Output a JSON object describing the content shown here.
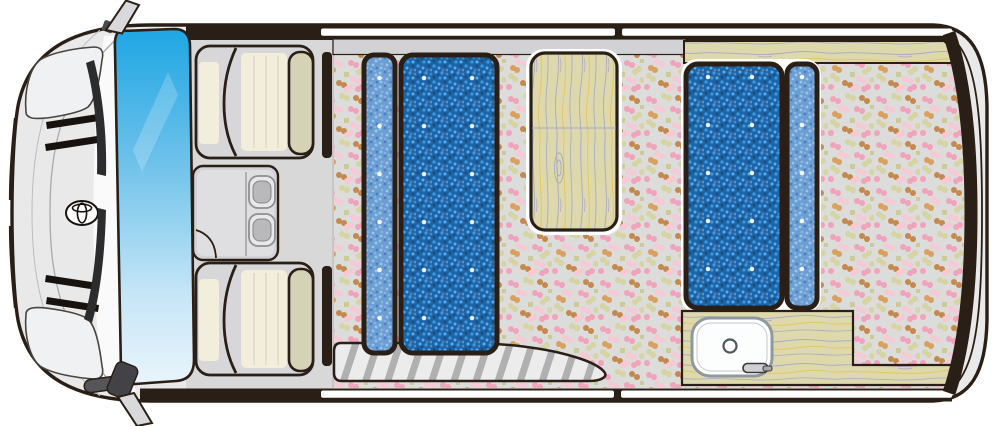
{
  "meta": {
    "description": "Top-view floor plan illustration of a camper van interior (front cab at left, living cabin with bed mats, table, kitchen sink and entry step)"
  },
  "colors": {
    "outline": "#2a1f17",
    "body": "#e9e9ea",
    "body_line": "#a9a9ac",
    "body_line2": "#bcbcbf",
    "highlight": "#fafafb",
    "cab_floor": "#d8d8d9",
    "glass_top": "#1ea6e4",
    "glass_mid": "#6fc2ea",
    "glass_pale": "#c7e6f7",
    "glass_low": "#e9f4fb",
    "seat_gray": "#d7d7d9",
    "seat_cream": "#f3eedb",
    "seat_pleat": "#dcd7c3",
    "headrest": "#d6d2b8",
    "console": "#d3d3d5",
    "console_inner": "#dfdfe1",
    "cup_outer": "#e8e8e9",
    "cup_inner": "#b9b9bb",
    "cup_stroke": "#8f8f92",
    "floor_base": "#dcdcda",
    "dot_pink": "#f1a3bb",
    "dot_pale": "#f6c9d5",
    "dot_olive": "#d7d4a3",
    "dot_khaki": "#ccc99b",
    "dot_tan": "#c3894f",
    "dot_orange": "#d9a05e",
    "mat_dark": "#1d64a9",
    "mat_dark_sp1": "#3f97d9",
    "mat_dark_sp2": "#57b0e8",
    "mat_dark_sp3": "#19507f",
    "mat_dark_sp4": "#64819f",
    "mat_light": "#6b9fd4",
    "mat_light_sp1": "#9cc3e8",
    "mat_light_sp2": "#4a80c0",
    "mat_light_sp3": "#8fb0d9",
    "button_dot": "#ffffff",
    "wood": "#ded9ac",
    "grain_gray": "#a8a8c4",
    "grain_yellow": "#e6c566",
    "trim": "#d2d2d4",
    "step_fill": "#ececed",
    "step_stripe": "#b0b0b2",
    "window": "#ffffff",
    "sink_white": "#fcfdfd",
    "sink_stroke": "#8e98a0",
    "drain": "#4e565e",
    "faucet": "#d0d0d2",
    "mirror": "#d9d9db",
    "wiper": "#2c2c2e",
    "grille": "#17120e",
    "halo": "#ffffff"
  },
  "van": {
    "brand_emblem": "toyota-style oval emblem",
    "windshield": "tinted blue windshield",
    "headlights": 2,
    "grille_slats": 4,
    "wipers": 2,
    "mirrors": [
      "upper door mirror",
      "lower door mirror"
    ],
    "windows": {
      "top_slots": 2,
      "bottom_slots": 2
    }
  },
  "cab": {
    "seats": [
      {
        "label": "front seat (upper)",
        "headrest": true
      },
      {
        "label": "front seat (lower)",
        "headrest": true
      }
    ],
    "console": {
      "label": "center console",
      "cup_holders": 2,
      "handle_arc": true
    },
    "pillars": 2
  },
  "cabin": {
    "side_trim": {
      "label": "upper side trim rail"
    },
    "rear_counter": {
      "label": "wood counter along rear-side window"
    },
    "front_bed": {
      "label": "front bed mats",
      "mats": [
        {
          "size": "narrow",
          "tone": "light",
          "button_rows": 6,
          "button_cols": 1
        },
        {
          "size": "wide",
          "tone": "dark",
          "button_rows": 6,
          "button_cols": 2
        }
      ]
    },
    "table": {
      "label": "wood folding table",
      "plank_seam": true,
      "knot": true
    },
    "rear_bed": {
      "label": "rear bed mats",
      "mats": [
        {
          "size": "wide",
          "tone": "dark",
          "button_rows": 5,
          "button_cols": 2
        },
        {
          "size": "narrow",
          "tone": "light",
          "button_rows": 5,
          "button_cols": 1
        }
      ]
    },
    "kitchen": {
      "label": "kitchen counter",
      "sink": "round-cornered sink",
      "drain": true,
      "faucet": true
    },
    "entry_step": {
      "label": "ribbed entry step"
    },
    "floor": {
      "label": "mosaic dotted floor"
    }
  }
}
